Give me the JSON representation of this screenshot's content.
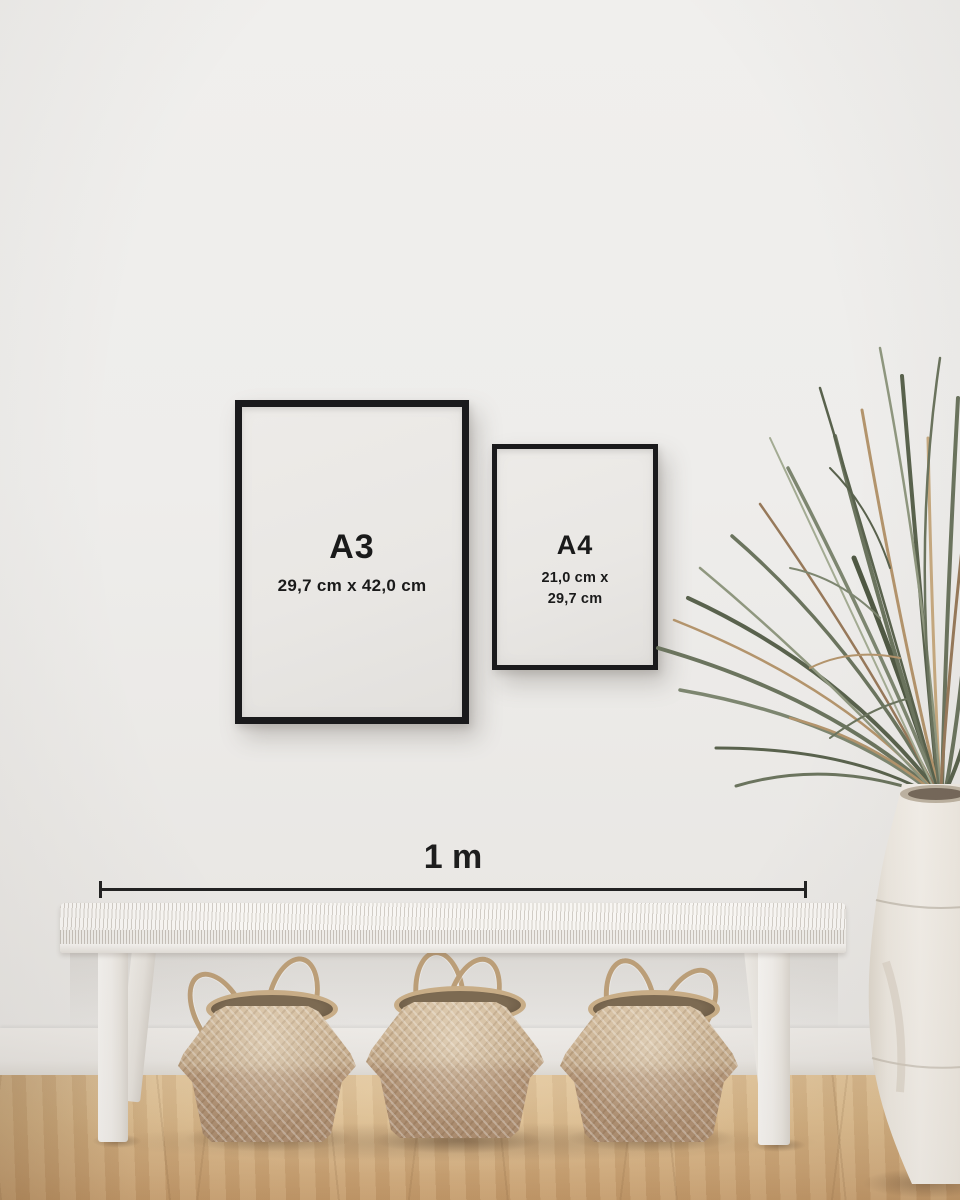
{
  "frames": [
    {
      "label": "A3",
      "dims": [
        "29,7 cm x 42,0 cm"
      ]
    },
    {
      "label": "A4",
      "dims": [
        "21,0 cm x",
        "29,7 cm"
      ]
    }
  ],
  "scale_bar": {
    "label": "1 m"
  },
  "scene_objects": {
    "wall": "plain light wall",
    "baseboard": "white skirting board",
    "floor": "light oak wood floor",
    "bench": "white woven bench",
    "baskets": [
      "seagrass belly basket",
      "seagrass belly basket",
      "seagrass belly basket"
    ],
    "plant": "dried palm plant",
    "vase": "white ceramic urn"
  },
  "colors": {
    "frame_border": "#1a1a1c",
    "frame_paper": "#eae8e5",
    "text": "#1a1a1a",
    "scale_line": "#222222",
    "wall": "#efeeec",
    "baseboard": "#e9e6e2",
    "floor_wood": "#d2ab7c",
    "bench_white": "#f2f0ed",
    "basket_weave": "#c2a888",
    "rope": "#bb9e78",
    "plant_green": "#6b745e",
    "plant_dried": "#b3946c",
    "vase_white": "#f0ebe4"
  }
}
